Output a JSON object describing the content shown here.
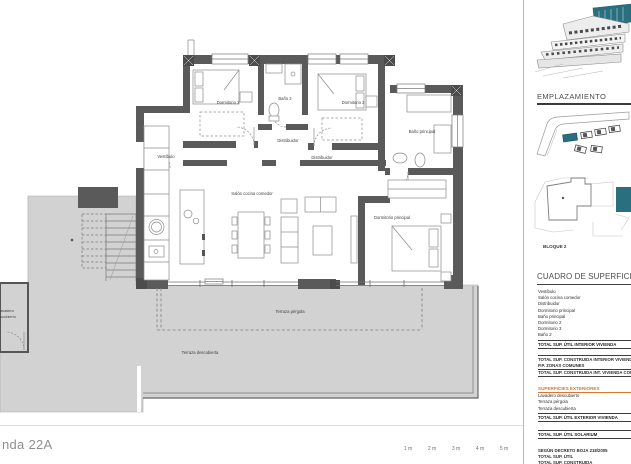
{
  "title_block": {
    "unit_title": "nda 22A"
  },
  "scale_bar": {
    "labels": [
      "1 m",
      "2 m",
      "3 m",
      "4 m",
      "5 m"
    ]
  },
  "plan": {
    "rooms": {
      "vestibulo": "Vestíbulo",
      "dormitorio3": "Dormitorio 3",
      "bano2": "Baño 2",
      "dormitorio2": "Dormitorio 2",
      "distribuidor": "Distribuidor",
      "distribuidor2": "Distribuidor",
      "bano_principal": "Baño principal",
      "salon": "Salón cocina comedor",
      "dormitorio_principal": "Dormitorio principal",
      "terraza_pergola": "Terraza pérgola",
      "terraza_descubierta": "Terraza descubierta",
      "lavadero_line1": "Lavadero",
      "lavadero_line2": "descubierto"
    }
  },
  "sidebar": {
    "emplazamiento": {
      "heading": "EMPLAZAMIENTO",
      "bloque_label": "BLOQUE 2"
    },
    "cuadro": {
      "heading": "CUADRO DE SUPERFICIES",
      "interior_rows": [
        "Vestíbulo",
        "Salón cocina comedor",
        "Distribuidor",
        "Dormitorio principal",
        "Baño principal",
        "Dormitorio 2",
        "Dormitorio 3",
        "Baño 2"
      ],
      "total_util_interior": "TOTAL SUP. ÚTIL INTERIOR VIVIENDA",
      "total_construida_interior": "TOTAL SUP. CONSTRUIDA INTERIOR VIVIENDA",
      "pp_zonas_comunes": "P.P. ZONAS COMUNES",
      "total_construida_con_pp": "TOTAL SUP. CONSTRUIDA INT. VIVIENDA CON P.P.",
      "exteriores_heading": "SUPERFICIES EXTERIORES",
      "exterior_rows": [
        "Lavadero descubierto",
        "Terraza pérgola",
        "Terraza descubierta"
      ],
      "total_util_exterior": "TOTAL SUP. ÚTIL EXTERIOR VIVIENDA",
      "total_util_solarium": "TOTAL SUP. ÚTIL SOLARIUM",
      "decreto_note": "SEGÚN DECRETO BOJA 218/2005",
      "total_util": "TOTAL SUP. ÚTIL",
      "total_construida": "TOTAL SUP. CONSTRUIDA"
    }
  },
  "colors": {
    "highlight_teal": "#2a6f7f",
    "exterior_orange": "#d9782d",
    "wall_gray": "#5a5a5a",
    "terrace_gray": "#d2d2d2"
  }
}
